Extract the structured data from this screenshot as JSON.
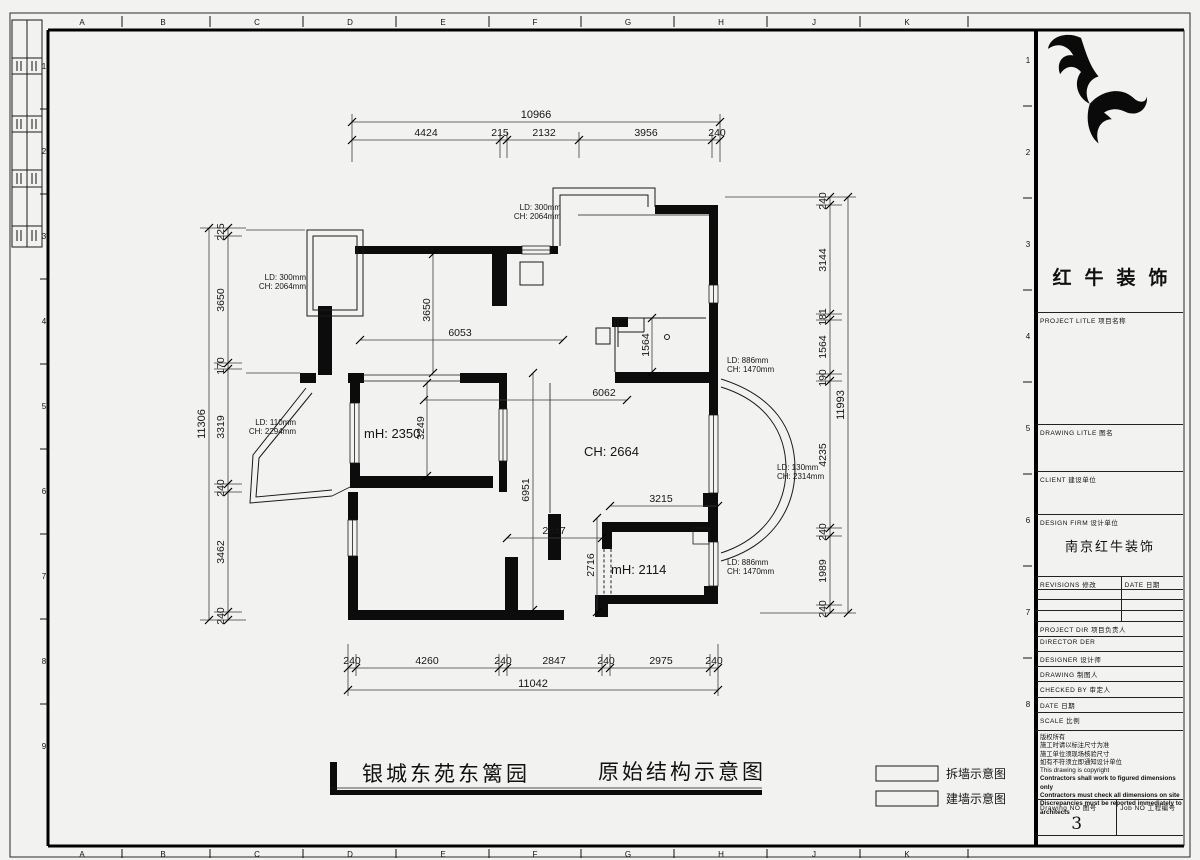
{
  "sheet": {
    "edge_letters": [
      "A",
      "B",
      "C",
      "D",
      "E",
      "F",
      "G",
      "H",
      "J",
      "K"
    ],
    "edge_numbers_left": [
      "1",
      "2",
      "3",
      "4",
      "5",
      "6",
      "7",
      "8",
      "9"
    ],
    "edge_numbers_right": [
      "1",
      "2",
      "3",
      "4",
      "5",
      "6",
      "7",
      "8"
    ]
  },
  "plan": {
    "dim_top": {
      "total": "10966",
      "segments": [
        "4424",
        "215",
        "2132",
        "3956",
        "240"
      ]
    },
    "dim_bottom": {
      "total": "11042",
      "segments": [
        "240",
        "4260",
        "240",
        "2847",
        "240",
        "2975",
        "240"
      ]
    },
    "dim_left": {
      "total": "11306",
      "segments": [
        "225",
        "3650",
        "170",
        "3319",
        "240",
        "3462",
        "240"
      ]
    },
    "dim_right": {
      "total": "11993",
      "segments": [
        "240",
        "3144",
        "181",
        "1564",
        "190",
        "4235",
        "240",
        "1989",
        "240"
      ]
    },
    "interior_dims": [
      "6053",
      "3650",
      "3249",
      "6062",
      "1564",
      "3215",
      "2847",
      "2716",
      "6951"
    ],
    "room_labels": [
      "mH: 2350",
      "CH: 2664",
      "mH: 2114"
    ],
    "window_labels": [
      {
        "l1": "LD: 300mm",
        "l2": "CH: 2064mm"
      },
      {
        "l1": "LD: 300mm",
        "l2": "CH: 2064mm"
      },
      {
        "l1": "LD: 110mm",
        "l2": "CH: 2294mm"
      },
      {
        "l1": "LD: 886mm",
        "l2": "CH: 1470mm"
      },
      {
        "l1": "LD: 130mm",
        "l2": "CH: 2314mm"
      },
      {
        "l1": "LD: 886mm",
        "l2": "CH: 1470mm"
      }
    ]
  },
  "footer": {
    "project_name": "银城东苑东篱园",
    "drawing_title": "原始结构示意图",
    "legend": [
      {
        "label": "拆墙示意图"
      },
      {
        "label": "建墙示意图"
      }
    ]
  },
  "titleblock": {
    "brand": "红牛装饰",
    "project_label": "PROJECT LITLE  项目名称",
    "drawing_title_label": "DRAWING LITLE  图名",
    "client_label": "CLIENT  建设单位",
    "design_firm_label": "DESIGN FIRM  设计单位",
    "design_firm_value": "南京红牛装饰",
    "revisions_label": "REVISIONS  修改",
    "revision_date_label": "DATE  日期",
    "project_dir_label": "PROJECT DIR  项目负责人",
    "director_label": "DIRECTOR DER",
    "designer_label": "DESIGNER  设计师",
    "drawing_label": "DRAWING  制图人",
    "checked_label": "CHECKED BY  审定人",
    "date_label": "DATE  日期",
    "scale_label": "SCALE  比例",
    "copyright_lines": [
      "版权所有",
      "施工时请以标注尺寸为准",
      "施工单位须现场核验尺寸",
      "如有不符须立即通知设计单位",
      "This drawing is copyright",
      "Contractors shall work to figured dimensions only",
      "Contractors must check all dimensions on site",
      "Discrepancies must be reported immediately to architects"
    ],
    "drawing_no_label": "Drawing NO  图号",
    "drawing_no": "3",
    "job_no_label": "Job NO  工程编号"
  }
}
